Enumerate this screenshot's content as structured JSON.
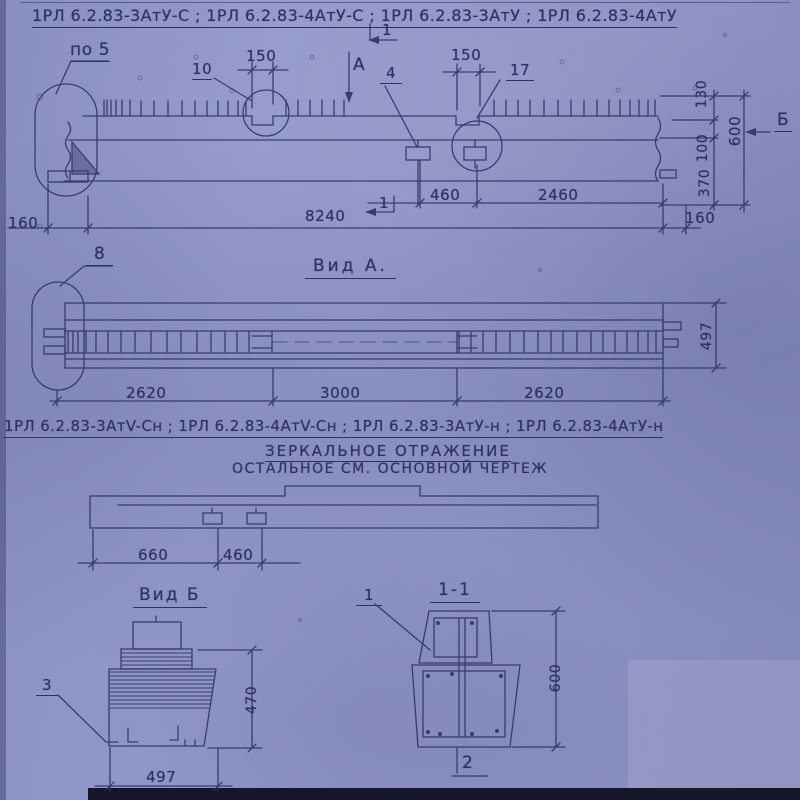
{
  "header": {
    "line1": "1РЛ 6.2.83-3АтУ-С ;  1РЛ 6.2.83-4АтУ-С ;  1РЛ 6.2.83-3АтУ ;  1РЛ 6.2.83-4АтУ",
    "line2": "1РЛ 6.2.83-3АтV-Сн ;  1РЛ 6.2.83-4АтV-Сн ;  1РЛ 6.2.83-3АтУ-н ;  1РЛ 6.2.83-4АтУ-н",
    "note_mirror": "ЗЕРКАЛЬНОЕ  ОТРАЖЕНИЕ",
    "note_rest": "ОСТАЛЬНОЕ  СМ.  ОСНОВНОЙ  ЧЕРТЕЖ"
  },
  "elevation": {
    "detail_label": "по 5",
    "dim_150_left": "150",
    "leader_10": "10",
    "section_mark_top": "1",
    "view_mark_a": "A",
    "leader_4": "4",
    "dim_150_right": "150",
    "leader_17": "17",
    "dim_130": "130",
    "dim_600": "600",
    "dim_100": "100",
    "dim_370": "370",
    "view_mark_b": "Б",
    "dim_160_left": "160",
    "dim_8240": "8240",
    "dim_460": "460",
    "dim_2460": "2460",
    "dim_160_right": "160",
    "section_mark_bottom": "1"
  },
  "view_a": {
    "title": "Вид А.",
    "leader_8": "8",
    "dim_2620_left": "2620",
    "dim_3000": "3000",
    "dim_2620_right": "2620",
    "dim_497": "497"
  },
  "mirror_plan": {
    "dim_660": "660",
    "dim_460": "460"
  },
  "view_b": {
    "title": "Вид Б",
    "leader_3": "3",
    "dim_470": "470",
    "dim_497": "497"
  },
  "section_1_1": {
    "title": "1-1",
    "leader_1": "1",
    "dim_600": "600",
    "leader_2": "2"
  },
  "colors": {
    "paper": "#8d92c4",
    "ink": "#2e3166"
  }
}
